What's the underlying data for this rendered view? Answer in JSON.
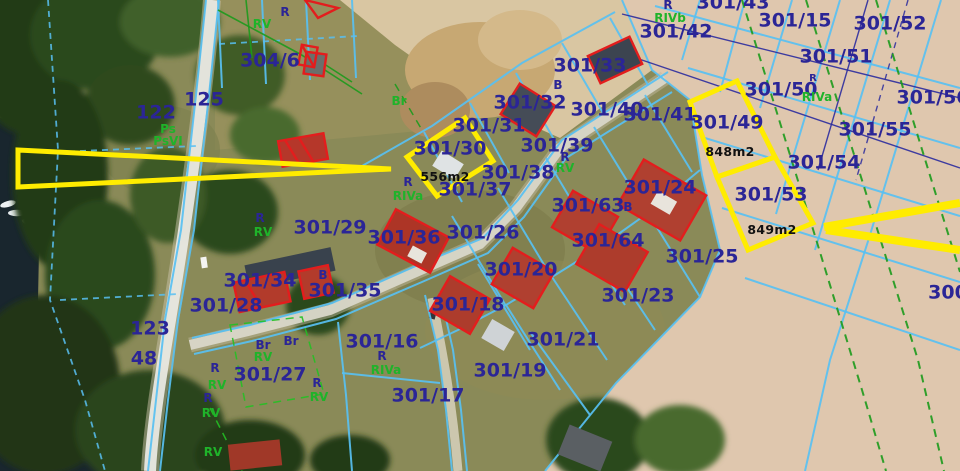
{
  "map": {
    "description": "aerial cadastral parcel map",
    "colors": {
      "parcel_text": "#2b2596",
      "landuse_text": "#1fb32a",
      "area_text": "#111111",
      "boundary_cyan": "#58c0f2",
      "boundary_navy": "#2b2b9e",
      "boundary_green": "#1c9a1c",
      "highlight_yellow": "#ffec00",
      "building_red": "#e31d1d"
    },
    "highlighted_parcels": [
      {
        "number": "301/30",
        "area": "556m2"
      },
      {
        "number": "301/49",
        "area": "848m2"
      },
      {
        "number": "301/53",
        "area": "849m2"
      }
    ],
    "labels": {
      "parcels": [
        {
          "t": "301/43",
          "x": 733,
          "y": 3
        },
        {
          "t": "301/15",
          "x": 795,
          "y": 21
        },
        {
          "t": "301/52",
          "x": 890,
          "y": 24
        },
        {
          "t": "301/42",
          "x": 676,
          "y": 32
        },
        {
          "t": "301/51",
          "x": 836,
          "y": 57
        },
        {
          "t": "301/33",
          "x": 590,
          "y": 66
        },
        {
          "t": "301/50",
          "x": 781,
          "y": 90
        },
        {
          "t": "301/56",
          "x": 933,
          "y": 98
        },
        {
          "t": "301/32",
          "x": 530,
          "y": 103
        },
        {
          "t": "301/40",
          "x": 607,
          "y": 110
        },
        {
          "t": "301/41",
          "x": 660,
          "y": 115
        },
        {
          "t": "301/31",
          "x": 489,
          "y": 126
        },
        {
          "t": "301/55",
          "x": 875,
          "y": 130
        },
        {
          "t": "301/30",
          "x": 450,
          "y": 149
        },
        {
          "t": "301/39",
          "x": 557,
          "y": 146
        },
        {
          "t": "301/49",
          "x": 727,
          "y": 123
        },
        {
          "t": "301/54",
          "x": 824,
          "y": 163
        },
        {
          "t": "301/38",
          "x": 518,
          "y": 173
        },
        {
          "t": "301/24",
          "x": 660,
          "y": 188
        },
        {
          "t": "301/37",
          "x": 475,
          "y": 190
        },
        {
          "t": "301/53",
          "x": 771,
          "y": 195
        },
        {
          "t": "301/63",
          "x": 588,
          "y": 206
        },
        {
          "t": "301/29",
          "x": 330,
          "y": 228
        },
        {
          "t": "301/26",
          "x": 483,
          "y": 233
        },
        {
          "t": "301/36",
          "x": 404,
          "y": 238
        },
        {
          "t": "301/64",
          "x": 608,
          "y": 241
        },
        {
          "t": "301/25",
          "x": 702,
          "y": 257
        },
        {
          "t": "301/20",
          "x": 521,
          "y": 270
        },
        {
          "t": "301/34",
          "x": 260,
          "y": 281
        },
        {
          "t": "301/35",
          "x": 345,
          "y": 291
        },
        {
          "t": "301/23",
          "x": 638,
          "y": 296
        },
        {
          "t": "301/18",
          "x": 468,
          "y": 305
        },
        {
          "t": "301/28",
          "x": 226,
          "y": 306
        },
        {
          "t": "301/16",
          "x": 382,
          "y": 342
        },
        {
          "t": "301/21",
          "x": 563,
          "y": 340
        },
        {
          "t": "301/19",
          "x": 510,
          "y": 371
        },
        {
          "t": "301/27",
          "x": 270,
          "y": 375
        },
        {
          "t": "301/17",
          "x": 428,
          "y": 396
        },
        {
          "t": "304/6",
          "x": 270,
          "y": 61
        },
        {
          "t": "300",
          "x": 948,
          "y": 293
        },
        {
          "t": "122",
          "x": 156,
          "y": 113
        },
        {
          "t": "125",
          "x": 204,
          "y": 100
        },
        {
          "t": "123",
          "x": 150,
          "y": 329
        },
        {
          "t": "48",
          "x": 144,
          "y": 359
        }
      ],
      "small_navy": [
        {
          "t": "R",
          "x": 285,
          "y": 12
        },
        {
          "t": "R",
          "x": 668,
          "y": 5
        },
        {
          "t": "R",
          "x": 813,
          "y": 79,
          "fs": 10
        },
        {
          "t": "R",
          "x": 565,
          "y": 157
        },
        {
          "t": "R",
          "x": 408,
          "y": 182
        },
        {
          "t": "R",
          "x": 260,
          "y": 218
        },
        {
          "t": "R",
          "x": 382,
          "y": 356
        },
        {
          "t": "R",
          "x": 215,
          "y": 368
        },
        {
          "t": "R",
          "x": 208,
          "y": 398
        },
        {
          "t": "R",
          "x": 317,
          "y": 383
        },
        {
          "t": "B",
          "x": 558,
          "y": 85
        },
        {
          "t": "B",
          "x": 628,
          "y": 207
        },
        {
          "t": "B",
          "x": 323,
          "y": 275
        },
        {
          "t": "Br",
          "x": 263,
          "y": 345
        },
        {
          "t": "Br",
          "x": 291,
          "y": 341
        }
      ],
      "green": [
        {
          "t": "RV",
          "x": 262,
          "y": 24
        },
        {
          "t": "RIVb",
          "x": 670,
          "y": 18
        },
        {
          "t": "RIVa",
          "x": 817,
          "y": 97
        },
        {
          "t": "RV",
          "x": 565,
          "y": 168
        },
        {
          "t": "RIVa",
          "x": 408,
          "y": 196
        },
        {
          "t": "RV",
          "x": 263,
          "y": 232
        },
        {
          "t": "RIVa",
          "x": 386,
          "y": 370
        },
        {
          "t": "Ps",
          "x": 168,
          "y": 129
        },
        {
          "t": "PsVI",
          "x": 168,
          "y": 141
        },
        {
          "t": "RV",
          "x": 217,
          "y": 385
        },
        {
          "t": "RV",
          "x": 211,
          "y": 413
        },
        {
          "t": "RV",
          "x": 319,
          "y": 397
        },
        {
          "t": "RV",
          "x": 263,
          "y": 357
        },
        {
          "t": "RV",
          "x": 213,
          "y": 452
        },
        {
          "t": "Br",
          "x": 399,
          "y": 101
        }
      ],
      "areas": [
        {
          "t": "556m2",
          "x": 445,
          "y": 177
        },
        {
          "t": "848m2",
          "x": 730,
          "y": 152
        },
        {
          "t": "849m2",
          "x": 772,
          "y": 230
        }
      ]
    }
  }
}
